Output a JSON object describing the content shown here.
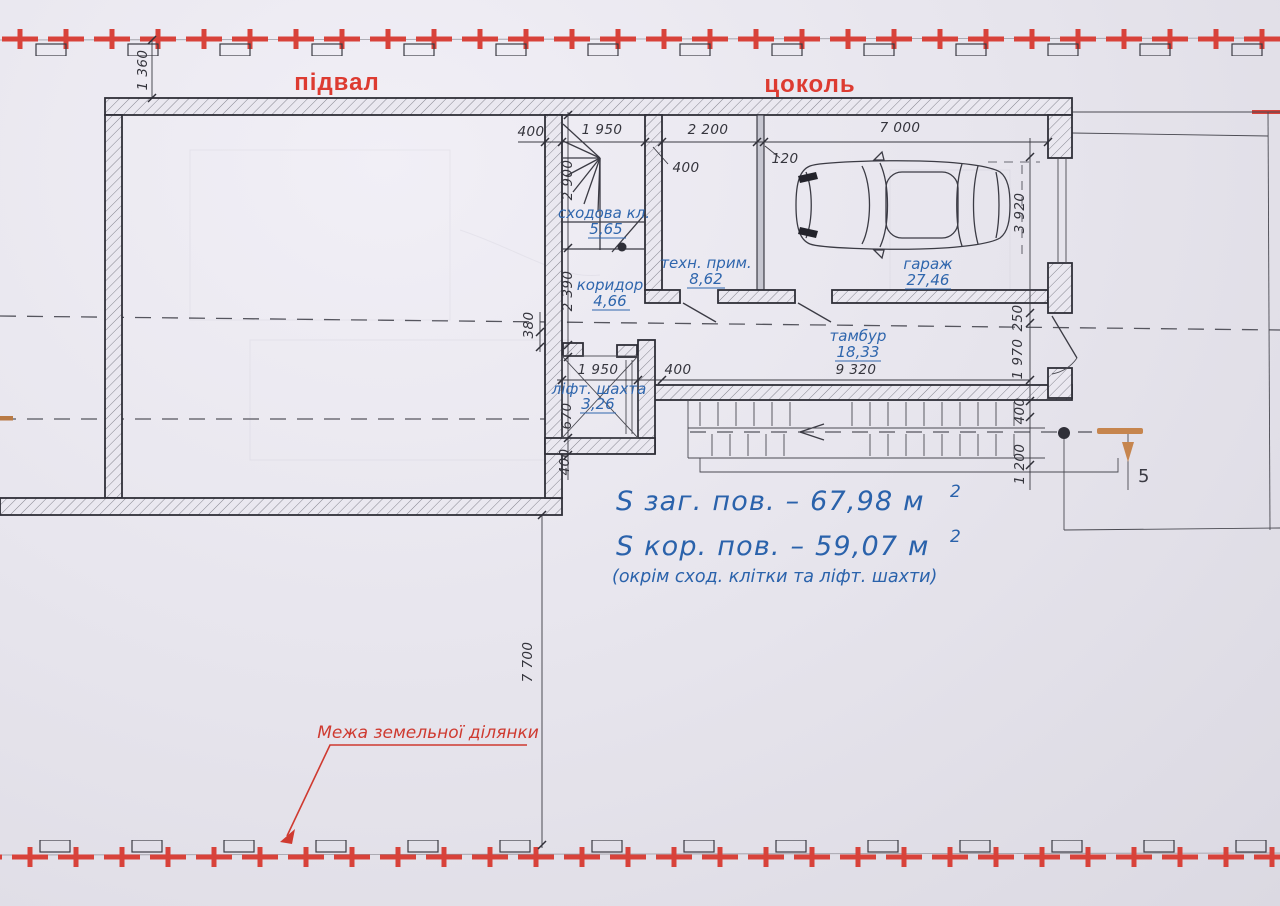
{
  "labels": {
    "basement": "підвал",
    "ground_floor": "цоколь"
  },
  "rooms": {
    "stair": {
      "name": "сходова кл.",
      "area": "5,65"
    },
    "corridor": {
      "name": "коридор",
      "area": "4,66"
    },
    "tech": {
      "name": "техн. прим.",
      "area": "8,62"
    },
    "garage": {
      "name": "гараж",
      "area": "27,46"
    },
    "tambour": {
      "name": "тамбур",
      "area": "18,33"
    },
    "lift": {
      "name": "ліфт. шахта",
      "area": "3,26"
    }
  },
  "dims": {
    "top_offset": "1 360",
    "stair_wall": "400",
    "stair_width": "1 950",
    "tech_width": "2 200",
    "garage_width": "7 000",
    "tech_wall": "400",
    "partition": "120",
    "stair_depth": "2 900",
    "corridor_depth": "2 390",
    "niche": "380",
    "garage_depth": "3 920",
    "d250": "250",
    "d1970": "1 970",
    "lift_width": "1 950",
    "lift_wall": "400",
    "tambour_length": "9 320",
    "lift_depth": "670",
    "bottom_wall": "400",
    "ramp_offset": "400",
    "ramp_depth": "1 200",
    "front_setback": "7 700"
  },
  "summary": {
    "total": "S заг.  пов.  –  67,98 м",
    "total_sup": "2",
    "usable": "S кор.  пов.  –  59,07 м",
    "usable_sup": "2",
    "note": "(окрім сход. клітки та ліфт. шахти)"
  },
  "annotations": {
    "site_boundary": "Межа земельної ділянки",
    "section_marker": "5"
  },
  "colors": {
    "boundary_red": "#d8423a",
    "plan_blue": "#2a62ab",
    "marker_tan": "#c6854e"
  }
}
